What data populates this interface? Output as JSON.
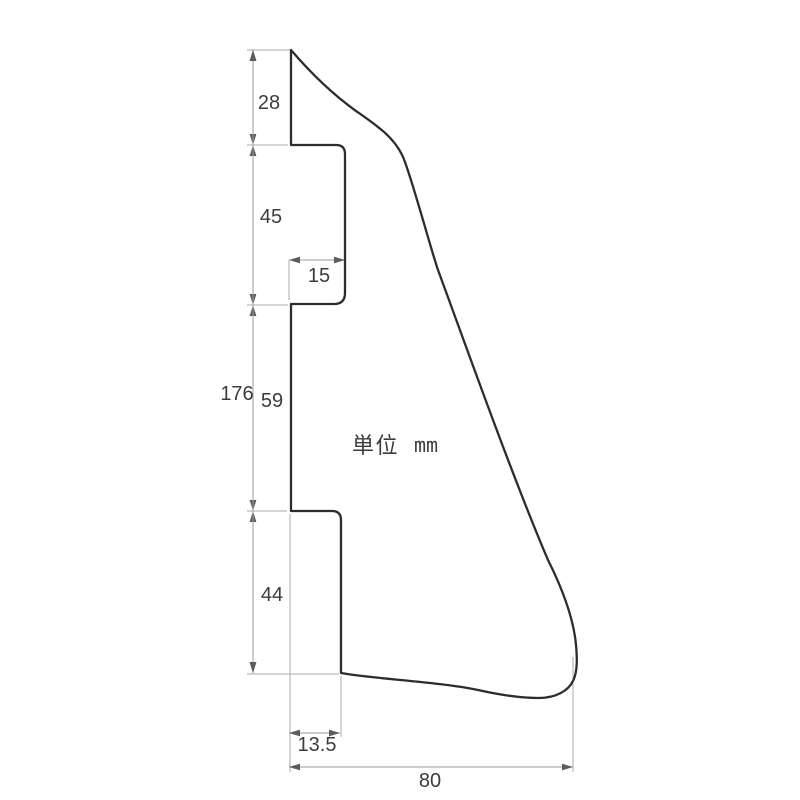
{
  "drawing": {
    "kind": "technical-dimension-drawing",
    "unit_note": {
      "prefix": "単位",
      "unit": "mm",
      "prefix_x": 352,
      "prefix_y": 453,
      "unit_x": 414,
      "unit_y": 452
    },
    "colors": {
      "background": "#ffffff",
      "outline": "#2d2d2d",
      "dim_line": "#9a9a9a",
      "ext_line": "#a8a8a8",
      "arrow": "#5c5c5c",
      "label": "#3c3c3c"
    },
    "outline_path": "M 291 50 L 291 145 L 336 145 Q 345 145 345 154 L 345 293 Q 345 304 334 304 L 291 304 L 291 511 L 332 511 Q 341 511 341 520 L 341 673 C 375 679 440 682 478 690 C 505 696 522 698 538 698 C 556 698 568 691 573 681 C 578 671 577 656 576 645 C 574 622 564 592 548 560 C 512 476 462 335 438 270 C 429 243 416 193 405 162 C 397 139 379 127 356 111 C 331 93 309 71 291 50 Z",
    "dimensions": [
      {
        "label": "28",
        "dir": "v",
        "line": 253,
        "from": 50,
        "to": 145,
        "label_x": 269,
        "label_y": 103
      },
      {
        "label": "45",
        "dir": "v",
        "line": 253,
        "from": 145,
        "to": 305,
        "label_x": 271,
        "label_y": 217
      },
      {
        "label": "59",
        "dir": "v",
        "line": 253,
        "from": 305,
        "to": 511,
        "label_x": 272,
        "label_y": 401
      },
      {
        "label": "44",
        "dir": "v",
        "line": 253,
        "from": 511,
        "to": 673,
        "label_x": 272,
        "label_y": 595
      },
      {
        "label": "176",
        "dir": "v",
        "line": 253,
        "from": 50,
        "to": 673,
        "label_x": 237,
        "label_y": 394
      },
      {
        "label": "15",
        "dir": "h",
        "line": 260,
        "from": 289,
        "to": 345,
        "label_x": 319,
        "label_y": 276
      },
      {
        "label": "13.5",
        "dir": "h",
        "line": 733,
        "from": 289,
        "to": 340,
        "label_x": 317,
        "label_y": 745
      },
      {
        "label": "80",
        "dir": "h",
        "line": 767,
        "from": 289,
        "to": 573,
        "label_x": 430,
        "label_y": 781
      }
    ],
    "extension_lines": [
      {
        "x1": 247,
        "y1": 50,
        "x2": 290,
        "y2": 50
      },
      {
        "x1": 247,
        "y1": 145,
        "x2": 288,
        "y2": 145
      },
      {
        "x1": 247,
        "y1": 305,
        "x2": 288,
        "y2": 305
      },
      {
        "x1": 247,
        "y1": 511,
        "x2": 287,
        "y2": 511
      },
      {
        "x1": 247,
        "y1": 674,
        "x2": 339,
        "y2": 674
      },
      {
        "x1": 289,
        "y1": 260,
        "x2": 289,
        "y2": 300
      },
      {
        "x1": 290,
        "y1": 514,
        "x2": 290,
        "y2": 772
      },
      {
        "x1": 341,
        "y1": 676,
        "x2": 341,
        "y2": 737
      },
      {
        "x1": 573,
        "y1": 657,
        "x2": 573,
        "y2": 772
      }
    ],
    "arrow": {
      "length": 11,
      "half_width": 3.4
    },
    "label_font_size": 20
  }
}
